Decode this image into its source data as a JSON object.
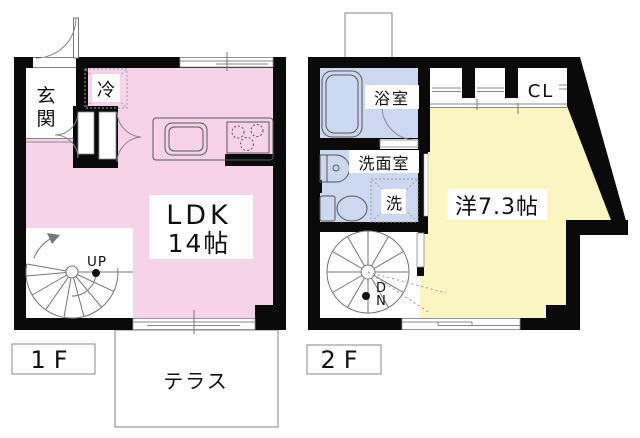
{
  "floor1": {
    "badge": "1F",
    "entrance_char1": "玄",
    "entrance_char2": "関",
    "fridge": "冷",
    "ldk_line1": "LDK",
    "ldk_line2": "14帖",
    "stair_label": "UP",
    "terrace": "テラス"
  },
  "floor2": {
    "badge": "2F",
    "bathroom": "浴室",
    "washroom": "洗面室",
    "washer": "洗",
    "closet": "CL",
    "room": "洋7.3帖",
    "stair_label_d": "D",
    "stair_label_n": "N"
  },
  "colors": {
    "ldk_pink": "#f7d3ea",
    "wet_blue": "#cbd8ef",
    "room_yellow": "#faf5c1",
    "wall_black": "#0a0a0a"
  }
}
